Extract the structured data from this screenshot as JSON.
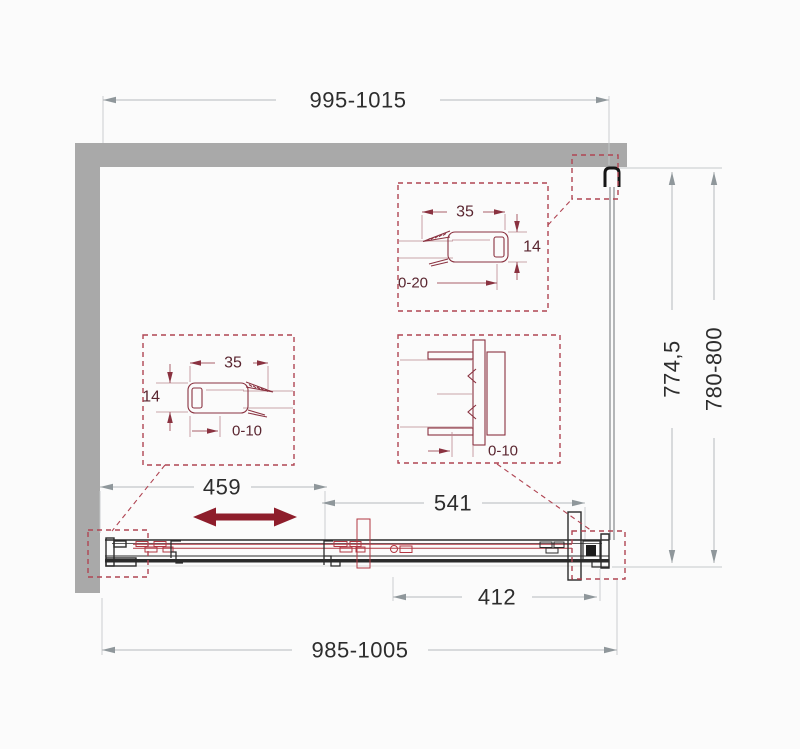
{
  "drawing": {
    "type": "shower-sliding-door-technical-plan",
    "dimensions": {
      "top_width": "995-1015",
      "bottom_width": "985-1005",
      "side_primary": "774,5",
      "side_range": "780-800",
      "section_left": "459",
      "section_middle": "541",
      "section_right": "412"
    },
    "detail_top_right": {
      "profile_width": "35",
      "profile_height": "14",
      "adjustment_range": "0-20"
    },
    "detail_middle_left": {
      "profile_width": "35",
      "profile_height": "14",
      "adjustment_range": "0-10"
    },
    "detail_middle_right": {
      "adjustment_range": "0-10"
    },
    "icons": {
      "slide_direction": "double-headed-arrow"
    },
    "colors": {
      "wall_gray": "#a9a9a9",
      "outline_black": "#2b2b2b",
      "dim_line_gray": "#b6babc",
      "dim_text": "#2d2d2d",
      "slide_arrow_red": "#8e1d2b",
      "detail_box_red": "#b04553",
      "profile_red": "#8a3240",
      "roller_red": "#b23742"
    }
  }
}
